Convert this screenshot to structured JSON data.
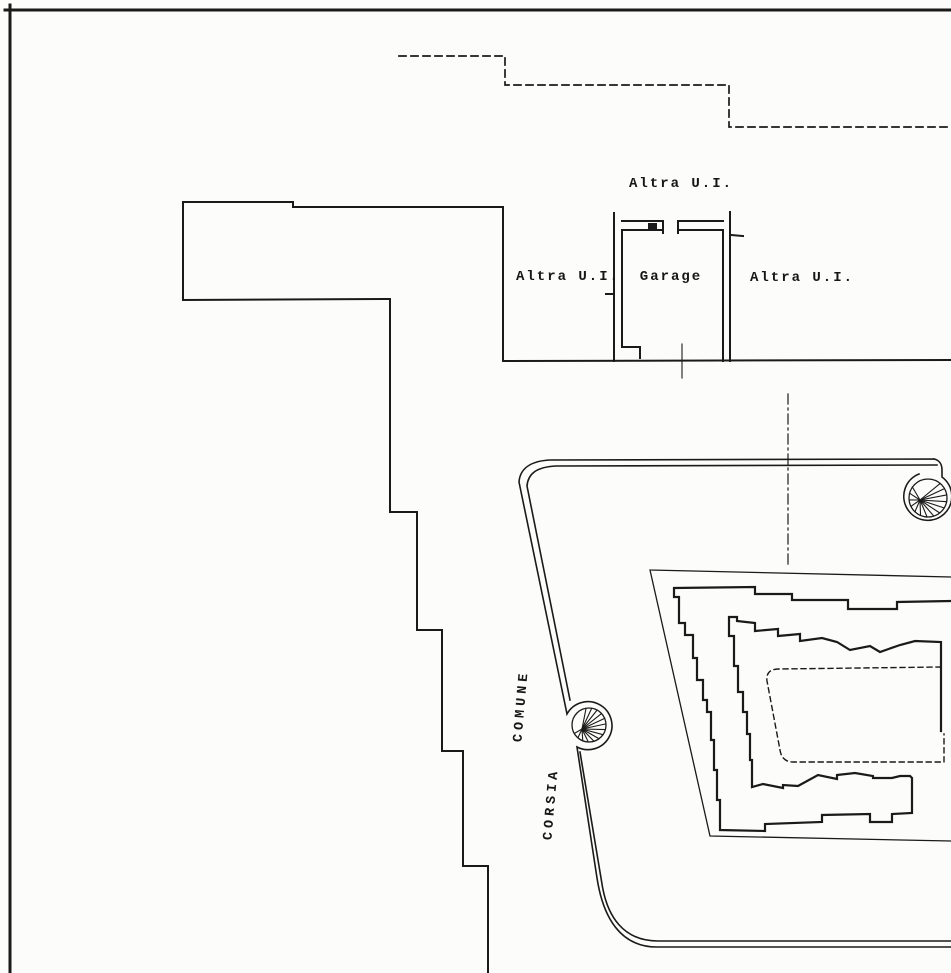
{
  "document": {
    "type": "cadastral-site-plan",
    "ink_color": "#1a1a1a",
    "paper_color": "#fcfcfa"
  },
  "labels": {
    "altra_ui_top": "Altra U.I.",
    "altra_ui_left": "Altra U.I.",
    "garage": "Garage",
    "altra_ui_right": "Altra U.I.",
    "corsia": "CORSIA",
    "comune": "COMUNE"
  },
  "paths": {
    "frame_top": "M5,10 L951,10",
    "frame_left": "M10,5 L10,973",
    "boundary_dashed": "M399,56 L505,56 L505,85 L729,85 L729,127 L951,127",
    "region_outline": "M503,361 L503,207 L293,207 L293,202 L183,202 L183,300 L390,299 L390,512 L417,512 L417,630 L442,630 L442,751 L463,751 L463,866 L488,866 L488,973",
    "baseline": "M503,361 L951,360",
    "garage_left_wall": "M614,213 L614,361 M622,232 L622,347 L640,347 L640,358 M606,294 L614,294",
    "garage_right_wall": "M730,212 L730,361 M723,232 L723,361 M731,235 L743,236",
    "garage_top_wall": "M622,221 L663,221 M622,230 L663,230 M663,221 L663,233 M678,221 L723,221 M678,230 L723,230 M678,221 L678,233",
    "garage_hinge": "M648,223 L657,223 L657,230 L648,230 Z",
    "garage_door_mark": "M682,344 L682,378",
    "section_axis": "M788,394 L788,566",
    "road_outer": "M934,459 L550,460 C530,461 520,469 519,482 L567,714 A24,24 0 1 1 577,747 L597,878 C603,917 620,947 657,947 L951,947 M934,459 C939,460 942,464 942,470 L942,477 A24,24 0 1 1 919,474",
    "road_inner": "M937,465 L556,466 C536,467 528,474 527,486 L570,700 M580,752 L602,884 C607,916 623,941 658,941 L951,941",
    "parcel_boundary": "M650,570 L951,577 M650,570 L710,836 L951,841",
    "building_outline": "M951,601 L897,602 L897,609 L848,609 L848,600 L792,600 L792,594 L755,594 L755,587 L674,588 L674,597 L679,597 L679,623 L685,623 L685,635 L693,635 L693,658 L697,658 L697,680 L703,680 L703,700 L707,700 L707,712 L711,712 L711,740 L714,740 L714,770 L717,770 L717,800 L720,800 L720,830 L765,831 L765,824 L822,822 L822,815 L870,814 L870,822 L892,822 L892,814 L912,813 L912,778 L910,776 L900,776 L892,778 L873,778 L873,776 L855,773 L837,775 L837,779 L818,775 L798,786 L783,785 L783,788 L763,784 L752,787 L752,760 L750,760 L750,734 L747,734 L747,712 L743,712 L743,692 L738,692 L738,666 L734,666 L734,636 L729,636 L729,617 L737,617 L737,621 L755,623 L755,631 L778,629 L778,636 L800,634 L800,641 L822,638 L837,642 L850,650 L870,646 L880,652 L900,645 L915,641 L941,642 L941,731",
    "courtyard_dashed": "M941,667 L779,669 C770,669 766,673 767,681 L780,750 C781,757 785,762 793,762 L944,762 L944,734"
  },
  "spirals": [
    {
      "name": "ramp-spiral-left",
      "cx": 589,
      "cy": 725,
      "ring_r": 17,
      "hub": [
        582,
        729
      ],
      "angle_start": -100,
      "angle_end": 150,
      "spokes": 14
    },
    {
      "name": "ramp-spiral-right",
      "cx": 928,
      "cy": 498,
      "ring_r": 19,
      "hub": [
        920,
        500
      ],
      "angle_start": -50,
      "angle_end": 215,
      "spokes": 14
    }
  ]
}
